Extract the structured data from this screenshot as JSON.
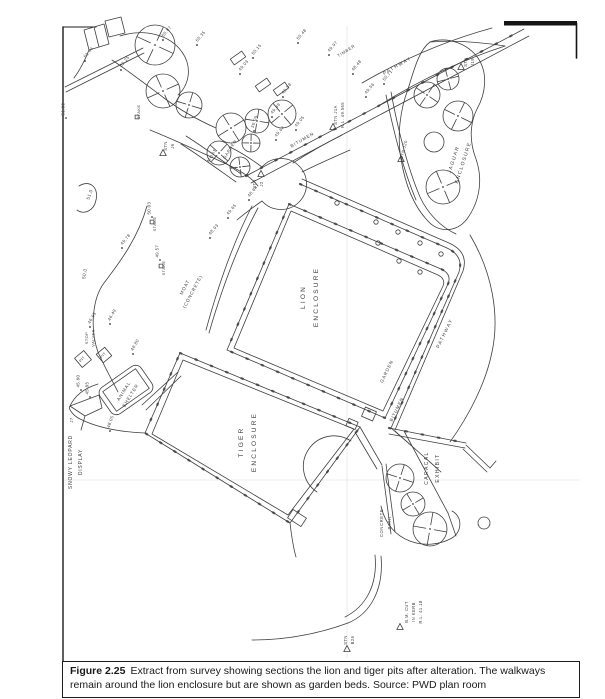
{
  "figure": {
    "caption_label": "Figure 2.25",
    "caption_text": "Extract from survey showing sections the lion and tiger pits after alteration. The walkways remain around the lion enclosure but are shown as garden beds. Source: PWD plan room"
  },
  "plan": {
    "ink": "#3f3f3f",
    "paper": "#ffffff",
    "labels": [
      {
        "name": "lion-enclosure-label",
        "text": "LION|ENCLOSURE",
        "x": 305,
        "y": 297,
        "rot": -90,
        "size": 6.5,
        "ls": 2.2,
        "gap": 13
      },
      {
        "name": "tiger-enclosure-label",
        "text": "TIGER|ENCLOSURE",
        "x": 243,
        "y": 442,
        "rot": -90,
        "size": 6.5,
        "ls": 2.2,
        "gap": 13
      },
      {
        "name": "jaguar-enclosure-label",
        "text": "JAGUAR|ENCLOSURE",
        "x": 455,
        "y": 160,
        "rot": -72,
        "size": 5,
        "ls": 1.4,
        "gap": 10
      },
      {
        "name": "caracal-exhibit-label",
        "text": "CARACAL|EXHIBIT",
        "x": 428,
        "y": 468,
        "rot": -90,
        "size": 5,
        "ls": 1.4,
        "gap": 11
      },
      {
        "name": "snowy-leopard-display-label",
        "text": "SNOWY LEOPARD|DISPLAY",
        "x": 72,
        "y": 462,
        "rot": -90,
        "size": 5,
        "ls": 0.8,
        "gap": 10
      },
      {
        "name": "animal-shelter-label",
        "text": "ANIMAL|SHELTER",
        "x": 125,
        "y": 392,
        "rot": -58,
        "size": 4.6,
        "ls": 0.8,
        "gap": 8
      },
      {
        "name": "pathway-top-label",
        "text": "PATHWAY",
        "x": 398,
        "y": 67,
        "rot": -30,
        "size": 4.8,
        "ls": 1.4
      },
      {
        "name": "pathway-right-label",
        "text": "PATHWAY",
        "x": 446,
        "y": 334,
        "rot": -64,
        "size": 4.8,
        "ls": 1.4
      },
      {
        "name": "bitumen-top-label",
        "text": "BITUMEN",
        "x": 303,
        "y": 141,
        "rot": -30,
        "size": 4.5,
        "ls": 0.9
      },
      {
        "name": "bitumen-right-label",
        "text": "BITUMEN",
        "x": 398,
        "y": 410,
        "rot": -64,
        "size": 4.5,
        "ls": 0.9
      },
      {
        "name": "garden-right-label",
        "text": "GARDEN",
        "x": 388,
        "y": 372,
        "rot": -64,
        "size": 4.5,
        "ls": 0.9
      },
      {
        "name": "garden-upper-label",
        "text": "GARDEN",
        "x": 231,
        "y": 150,
        "rot": -58,
        "size": 4.2,
        "ls": 0.7
      },
      {
        "name": "moat-upper-label",
        "text": "MOAT",
        "x": 213,
        "y": 156,
        "rot": -58,
        "size": 4.2,
        "ls": 0.7
      },
      {
        "name": "moat-concrete-label",
        "text": "MOAT|(CONCRETE)",
        "x": 186,
        "y": 288,
        "rot": -62,
        "size": 4.6,
        "ls": 0.8,
        "gap": 9
      },
      {
        "name": "concrete-path-label",
        "text": "CONCRETE|PATH",
        "x": 383,
        "y": 523,
        "rot": -90,
        "size": 4.2,
        "ls": 0.6,
        "gap": 8
      },
      {
        "name": "timber-label",
        "text": "TIMBER",
        "x": 347,
        "y": 52,
        "rot": -32,
        "size": 4.2,
        "ls": 0.7
      },
      {
        "name": "stop-valves-label",
        "text": "STOP|VALVES",
        "x": 88,
        "y": 338,
        "rot": -90,
        "size": 4,
        "ls": 0.4,
        "gap": 6.5
      },
      {
        "name": "pit-label-1",
        "text": "PIT",
        "x": 83,
        "y": 360,
        "rot": -48,
        "size": 3.8,
        "ls": 0.3
      },
      {
        "name": "pit-label-2",
        "text": "PIT",
        "x": 104,
        "y": 356,
        "rot": -48,
        "size": 3.8,
        "ls": 0.3
      },
      {
        "name": "station-j1a-label",
        "text": "STN J1A|R.L. 49.565",
        "x": 337,
        "y": 115,
        "rot": -90,
        "size": 4.2,
        "ls": 0.4,
        "gap": 7
      },
      {
        "name": "station-j2-label",
        "text": "STN|J2",
        "x": 256,
        "y": 184,
        "rot": -90,
        "size": 4.2,
        "ls": 0.4,
        "gap": 7
      },
      {
        "name": "station-j20-label",
        "text": "STN J20",
        "x": 405,
        "y": 150,
        "rot": -75,
        "size": 4.2,
        "ls": 0.4
      },
      {
        "name": "station-j19-label",
        "text": "STN|J19",
        "x": 467,
        "y": 62,
        "rot": -90,
        "size": 4.2,
        "ls": 0.4,
        "gap": 7
      },
      {
        "name": "station-j6-label",
        "text": "STN|J6",
        "x": 167,
        "y": 146,
        "rot": -90,
        "size": 4.2,
        "ls": 0.4,
        "gap": 7
      },
      {
        "name": "station-b26-label",
        "text": "STN|B26",
        "x": 347,
        "y": 640,
        "rot": -90,
        "size": 4.2,
        "ls": 0.4,
        "gap": 7
      },
      {
        "name": "benchmark-label",
        "text": "B.M. CUT|IN KERB|R.L. 41.18",
        "x": 408,
        "y": 612,
        "rot": -90,
        "size": 4.2,
        "ls": 0.4,
        "gap": 7
      },
      {
        "name": "stake-label-1",
        "text": "STAKE",
        "x": 140,
        "y": 112,
        "rot": -90,
        "size": 4,
        "ls": 0.4
      },
      {
        "name": "stake-label-2",
        "text": "STAKE",
        "x": 156,
        "y": 224,
        "rot": -90,
        "size": 4,
        "ls": 0.4
      },
      {
        "name": "stake-label-3",
        "text": "STAKE",
        "x": 165,
        "y": 268,
        "rot": -90,
        "size": 4,
        "ls": 0.4
      },
      {
        "name": "contour-51-label",
        "text": "51.0",
        "x": 91,
        "y": 195,
        "rot": -70,
        "size": 4.6,
        "ls": 0.4
      },
      {
        "name": "contour-50-label",
        "text": "50.0",
        "x": 86,
        "y": 274,
        "rot": -80,
        "size": 4.6,
        "ls": 0.4
      },
      {
        "name": "j7-label",
        "text": "J7",
        "x": 73,
        "y": 420,
        "rot": -90,
        "size": 4.2,
        "ls": 0.4
      }
    ],
    "stations": [
      {
        "x": 261,
        "y": 174
      },
      {
        "x": 333,
        "y": 127
      },
      {
        "x": 401,
        "y": 159
      },
      {
        "x": 461,
        "y": 67
      },
      {
        "x": 163,
        "y": 153
      },
      {
        "x": 347,
        "y": 649
      },
      {
        "x": 400,
        "y": 627
      }
    ],
    "spot_heights": [
      {
        "v": "51.02",
        "x": 66,
        "y": 118,
        "rot": -90
      },
      {
        "v": "51.44",
        "x": 85,
        "y": 61,
        "rot": -50
      },
      {
        "v": "52.25",
        "x": 121,
        "y": 70,
        "rot": -50
      },
      {
        "v": "50.87",
        "x": 163,
        "y": 40,
        "rot": -50
      },
      {
        "v": "50.35",
        "x": 197,
        "y": 45,
        "rot": -50
      },
      {
        "v": "50.15",
        "x": 253,
        "y": 58,
        "rot": -50
      },
      {
        "v": "49.03",
        "x": 240,
        "y": 74,
        "rot": -50
      },
      {
        "v": "50.48",
        "x": 298,
        "y": 43,
        "rot": -50
      },
      {
        "v": "49.97",
        "x": 329,
        "y": 55,
        "rot": -50
      },
      {
        "v": "48.48",
        "x": 353,
        "y": 74,
        "rot": -50
      },
      {
        "v": "50.71",
        "x": 384,
        "y": 84,
        "rot": -50
      },
      {
        "v": "49.56",
        "x": 366,
        "y": 97,
        "rot": -50
      },
      {
        "v": "49.58",
        "x": 283,
        "y": 97,
        "rot": -50
      },
      {
        "v": "49.49",
        "x": 272,
        "y": 117,
        "rot": -50
      },
      {
        "v": "50.09",
        "x": 254,
        "y": 131,
        "rot": -70
      },
      {
        "v": "49.64",
        "x": 276,
        "y": 140,
        "rot": -50
      },
      {
        "v": "49.05",
        "x": 296,
        "y": 130,
        "rot": -50
      },
      {
        "v": "48.64",
        "x": 249,
        "y": 200,
        "rot": -50
      },
      {
        "v": "50.03",
        "x": 152,
        "y": 217,
        "rot": -90
      },
      {
        "v": "49.57",
        "x": 160,
        "y": 260,
        "rot": -90
      },
      {
        "v": "49.78",
        "x": 122,
        "y": 248,
        "rot": -50
      },
      {
        "v": "49.65",
        "x": 228,
        "y": 218,
        "rot": -50
      },
      {
        "v": "48.93",
        "x": 210,
        "y": 238,
        "rot": -50
      },
      {
        "v": "46.63",
        "x": 90,
        "y": 327,
        "rot": -60
      },
      {
        "v": "46.49",
        "x": 110,
        "y": 324,
        "rot": -60
      },
      {
        "v": "45.80",
        "x": 81,
        "y": 390,
        "rot": -90
      },
      {
        "v": "45.85",
        "x": 90,
        "y": 397,
        "rot": -90
      },
      {
        "v": "48.05",
        "x": 110,
        "y": 431,
        "rot": -70
      },
      {
        "v": "48.80",
        "x": 133,
        "y": 354,
        "rot": -60
      }
    ],
    "trees": [
      {
        "x": 155,
        "y": 45,
        "r": 20
      },
      {
        "x": 163,
        "y": 91,
        "r": 17
      },
      {
        "x": 189,
        "y": 105,
        "r": 13
      },
      {
        "x": 231,
        "y": 128,
        "r": 15
      },
      {
        "x": 257,
        "y": 121,
        "r": 12
      },
      {
        "x": 282,
        "y": 114,
        "r": 14
      },
      {
        "x": 251,
        "y": 143,
        "r": 9
      },
      {
        "x": 219,
        "y": 153,
        "r": 12
      },
      {
        "x": 240,
        "y": 167,
        "r": 10
      },
      {
        "x": 427,
        "y": 95,
        "r": 13
      },
      {
        "x": 448,
        "y": 79,
        "r": 11
      },
      {
        "x": 458,
        "y": 116,
        "r": 15
      },
      {
        "x": 443,
        "y": 187,
        "r": 17
      },
      {
        "x": 400,
        "y": 478,
        "r": 14
      },
      {
        "x": 413,
        "y": 504,
        "r": 12
      },
      {
        "x": 430,
        "y": 529,
        "r": 17
      }
    ],
    "plain_circles": [
      {
        "x": 434,
        "y": 142,
        "r": 10
      },
      {
        "x": 484,
        "y": 523,
        "r": 6
      }
    ],
    "garden_dots": [
      {
        "x": 337,
        "y": 203
      },
      {
        "x": 376,
        "y": 222
      },
      {
        "x": 398,
        "y": 232
      },
      {
        "x": 420,
        "y": 243
      },
      {
        "x": 441,
        "y": 254
      },
      {
        "x": 378,
        "y": 243
      },
      {
        "x": 399,
        "y": 261
      },
      {
        "x": 420,
        "y": 272
      }
    ],
    "stake_squares": [
      {
        "x": 137,
        "y": 117
      },
      {
        "x": 152,
        "y": 222
      },
      {
        "x": 161,
        "y": 266
      }
    ],
    "post_rects": [
      {
        "x": 238,
        "y": 58,
        "rot": -35
      },
      {
        "x": 263,
        "y": 85,
        "rot": -35
      },
      {
        "x": 281,
        "y": 89,
        "rot": -35
      }
    ]
  }
}
